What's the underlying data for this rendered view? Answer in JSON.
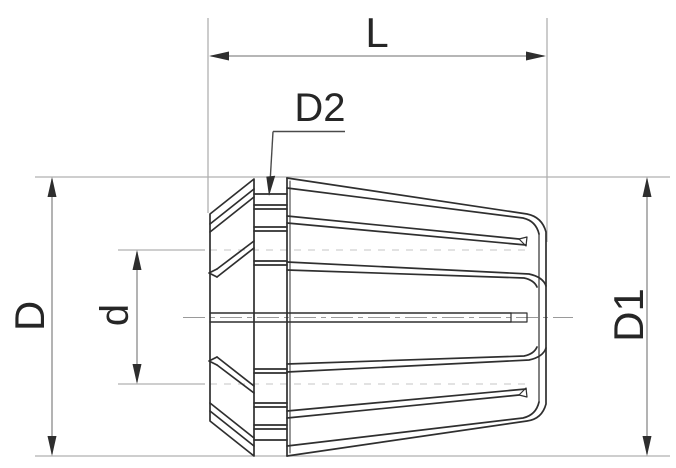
{
  "drawing": {
    "type": "technical-dimension-drawing",
    "subject": "ER collet side view",
    "labels": {
      "overall_length": "L",
      "neck_diameter": "D2",
      "back_diameter": "D",
      "bore_diameter": "d",
      "front_diameter": "D1"
    },
    "colors": {
      "part_line": "#2f2f2f",
      "dimension_line": "#8a8a8a",
      "extension_line": "#b0b0b0",
      "hidden_line": "#c4c4c4",
      "center_line": "#9a9a9a",
      "leader_line": "#4a4a4a",
      "arrow": "#2e2e2e",
      "label_text": "#262626",
      "background": "#ffffff"
    }
  }
}
